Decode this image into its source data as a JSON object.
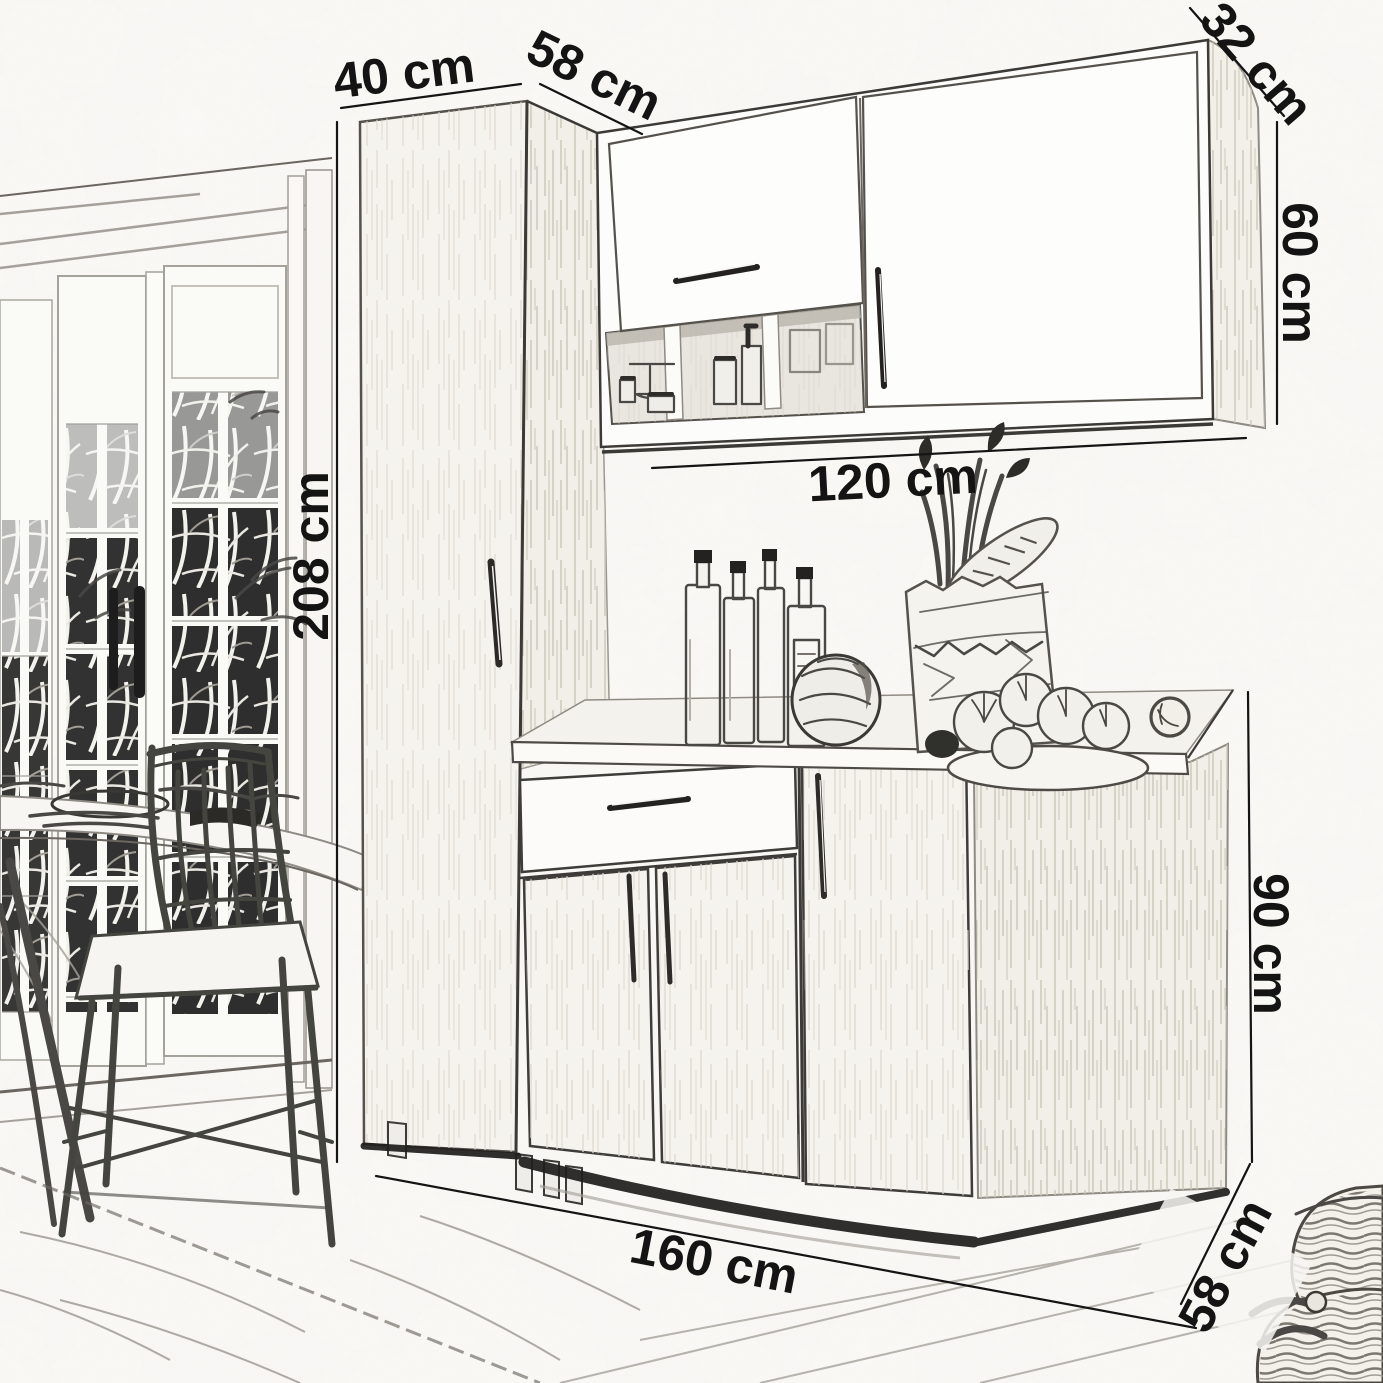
{
  "diagram": {
    "type": "furniture-dimension-sketch",
    "subject": "kitchen-cabinet-set",
    "dimensions": {
      "tall_cabinet_width": "40 cm",
      "tall_cabinet_depth": "58 cm",
      "wall_cabinet_depth": "32 cm",
      "wall_cabinet_height": "60 cm",
      "tall_cabinet_height": "208 cm",
      "wall_cabinet_width": "120 cm",
      "base_cabinet_height": "90 cm",
      "base_cabinet_width": "160 cm",
      "base_cabinet_depth": "58 cm"
    },
    "colors": {
      "paper": "#fbfaf7",
      "line": "#141414",
      "sketch": "#4a4845",
      "wood": "#f5f3ee",
      "wood_stroke": "#d6d1c6",
      "shadow": "#201e1c",
      "foliage": "#212121"
    }
  }
}
